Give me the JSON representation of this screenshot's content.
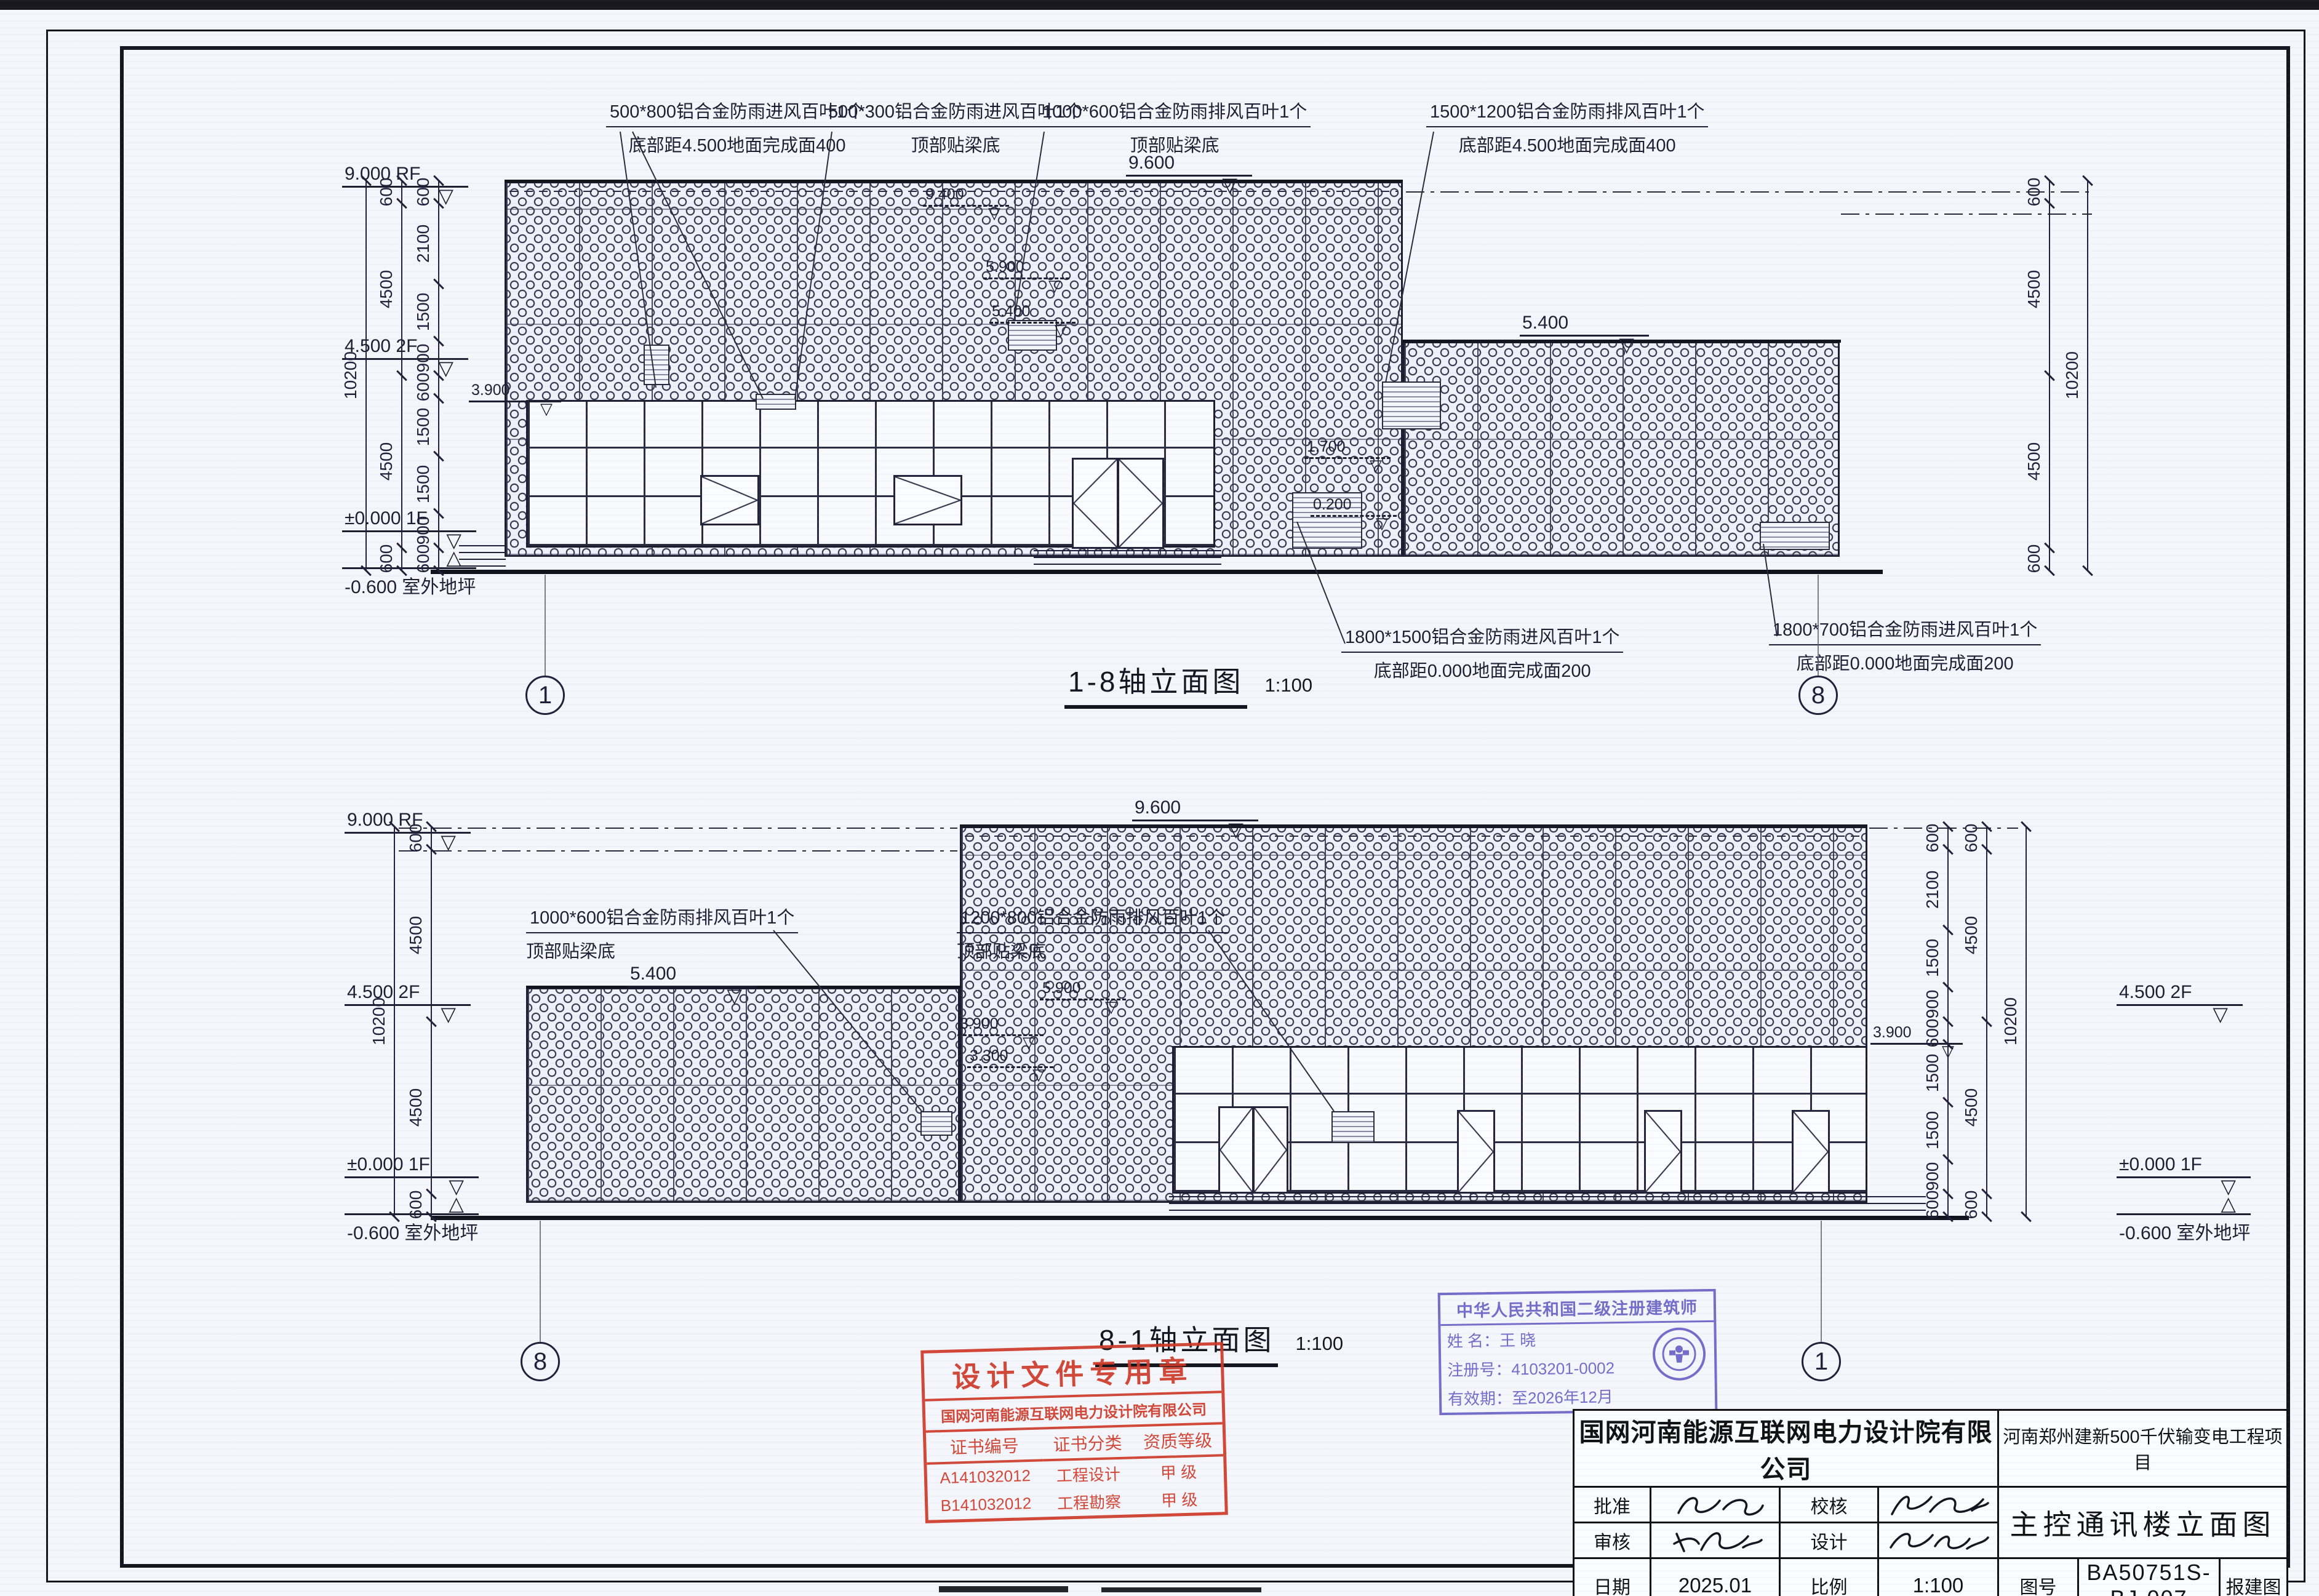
{
  "elevation1": {
    "title": "1-8轴立面图",
    "scale": "1:100",
    "axis_left": "1",
    "axis_right": "8",
    "notes_top": [
      {
        "line1": "500*800铝合金防雨进风百叶1个",
        "line2": "底部距4.500地面完成面400"
      },
      {
        "line1": "500*300铝合金防雨进风百叶1个",
        "line2": "顶部贴梁底"
      },
      {
        "line1": "1000*600铝合金防雨排风百叶1个",
        "line2": "顶部贴梁底"
      },
      {
        "line1": "1500*1200铝合金防雨排风百叶1个",
        "line2": "底部距4.500地面完成面400"
      }
    ],
    "notes_bottom": [
      {
        "line1": "1800*1500铝合金防雨进风百叶1个",
        "line2": "底部距0.000地面完成面200"
      },
      {
        "line1": "1800*700铝合金防雨进风百叶1个",
        "line2": "底部距0.000地面完成面200"
      }
    ],
    "levels": {
      "rf": "9.000 RF",
      "f2": "4.500 2F",
      "f1": "±0.000 1F",
      "ground": "-0.600 室外地坪",
      "parapet": "9.600",
      "mid": "3.900",
      "roof_low": "5.400",
      "m94": "9.400",
      "m59": "5.900",
      "m54": "5.400",
      "m17": "1.700",
      "m02": "0.200"
    },
    "dims_inner": [
      "600",
      "2100",
      "1500",
      "900",
      "600",
      "1500",
      "1500",
      "900",
      "600"
    ],
    "dims_mid": [
      "600",
      "4500",
      "4500",
      "600"
    ],
    "dims_outer": [
      "10200"
    ]
  },
  "elevation2": {
    "title": "8-1轴立面图",
    "scale": "1:100",
    "axis_left": "8",
    "axis_right": "1",
    "notes_top": [
      {
        "line1": "1000*600铝合金防雨排风百叶1个",
        "line2": "顶部贴梁底"
      },
      {
        "line1": "1200*800铝合金防雨排风百叶1个",
        "line2": "顶部贴梁底"
      }
    ],
    "levels": {
      "rf": "9.000 RF",
      "f2": "4.500 2F",
      "f1": "±0.000 1F",
      "ground": "-0.600 室外地坪",
      "parapet": "9.600",
      "roof_low": "5.400",
      "r_f2": "4.500 2F",
      "r_f1": "±0.000 1F",
      "r_ground": "-0.600 室外地坪",
      "r_mid": "3.900",
      "i59": "5.900",
      "i39": "3.900",
      "i33": "3.300"
    },
    "dims_inner": [
      "600",
      "2100",
      "1500",
      "900",
      "600",
      "1500",
      "1500",
      "900",
      "600"
    ],
    "dims_mid": [
      "600",
      "4500",
      "4500",
      "600"
    ],
    "dims_outer": [
      "10200"
    ]
  },
  "stamp_red": {
    "title": "设计文件专用章",
    "company": "国网河南能源互联网电力设计院有限公司",
    "col1": "证书编号",
    "col2": "证书分类",
    "col3": "资质等级",
    "rows": [
      [
        "A141032012",
        "工程设计",
        "甲 级"
      ],
      [
        "B141032012",
        "工程勘察",
        "甲 级"
      ]
    ]
  },
  "stamp_blue": {
    "title": "中华人民共和国二级注册建筑师",
    "name_label": "姓  名：",
    "name": "王  晓",
    "reg_label": "注册号：",
    "reg": "4103201-0002",
    "valid_label": "有效期：",
    "valid": "至2026年12月"
  },
  "titleblock": {
    "company": "国网河南能源互联网电力设计院有限公司",
    "project": "河南郑州建新500千伏输变电工程项目",
    "drawing_title": "主控通讯楼立面图",
    "labels": {
      "approve": "批准",
      "review": "审核",
      "check": "校核",
      "design": "设计",
      "date": "日期",
      "scale": "比例",
      "fig_no": "图号",
      "stage": "报建图"
    },
    "values": {
      "date": "2025.01",
      "scale": "1:100",
      "fig_no": "BA50751S-BJ-007"
    }
  }
}
